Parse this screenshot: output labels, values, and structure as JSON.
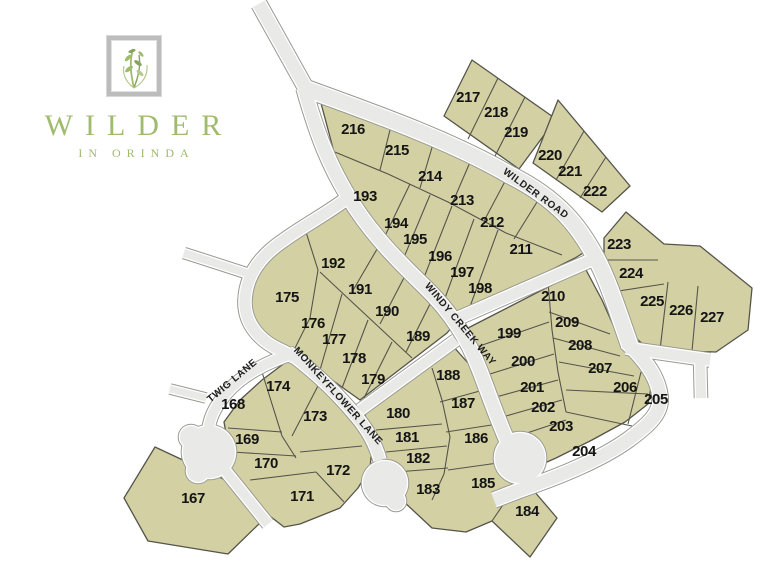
{
  "logo": {
    "title": "WILDER",
    "subtitle": "IN ORINDA"
  },
  "map": {
    "roads": [
      {
        "id": "wilder-road",
        "name": "WILDER ROAD",
        "x": 534,
        "y": 196,
        "angle": 36
      },
      {
        "id": "windy-creek-way",
        "name": "WINDY CREEK WAY",
        "x": 458,
        "y": 326,
        "angle": 50
      },
      {
        "id": "monkeyflower-lane",
        "name": "MONKEYFLOWER LANE",
        "x": 336,
        "y": 398,
        "angle": 48
      },
      {
        "id": "twig-lane",
        "name": "TWIG LANE",
        "x": 234,
        "y": 383,
        "angle": -40
      }
    ],
    "lots": [
      {
        "number": "167",
        "x": 193,
        "y": 498
      },
      {
        "number": "168",
        "x": 233,
        "y": 404
      },
      {
        "number": "169",
        "x": 247,
        "y": 439
      },
      {
        "number": "170",
        "x": 266,
        "y": 463
      },
      {
        "number": "171",
        "x": 302,
        "y": 496
      },
      {
        "number": "172",
        "x": 338,
        "y": 470
      },
      {
        "number": "173",
        "x": 315,
        "y": 416
      },
      {
        "number": "174",
        "x": 278,
        "y": 386
      },
      {
        "number": "175",
        "x": 287,
        "y": 297
      },
      {
        "number": "176",
        "x": 313,
        "y": 323
      },
      {
        "number": "177",
        "x": 334,
        "y": 339
      },
      {
        "number": "178",
        "x": 354,
        "y": 358
      },
      {
        "number": "179",
        "x": 373,
        "y": 379
      },
      {
        "number": "180",
        "x": 398,
        "y": 413
      },
      {
        "number": "181",
        "x": 407,
        "y": 437
      },
      {
        "number": "182",
        "x": 418,
        "y": 458
      },
      {
        "number": "183",
        "x": 428,
        "y": 489
      },
      {
        "number": "184",
        "x": 527,
        "y": 511
      },
      {
        "number": "185",
        "x": 483,
        "y": 483
      },
      {
        "number": "186",
        "x": 476,
        "y": 438
      },
      {
        "number": "187",
        "x": 463,
        "y": 403
      },
      {
        "number": "188",
        "x": 448,
        "y": 375
      },
      {
        "number": "189",
        "x": 418,
        "y": 336
      },
      {
        "number": "190",
        "x": 387,
        "y": 311
      },
      {
        "number": "191",
        "x": 360,
        "y": 289
      },
      {
        "number": "192",
        "x": 333,
        "y": 263
      },
      {
        "number": "193",
        "x": 365,
        "y": 196
      },
      {
        "number": "194",
        "x": 396,
        "y": 223
      },
      {
        "number": "195",
        "x": 415,
        "y": 239
      },
      {
        "number": "196",
        "x": 440,
        "y": 256
      },
      {
        "number": "197",
        "x": 462,
        "y": 272
      },
      {
        "number": "198",
        "x": 480,
        "y": 288
      },
      {
        "number": "199",
        "x": 509,
        "y": 333
      },
      {
        "number": "200",
        "x": 523,
        "y": 361
      },
      {
        "number": "201",
        "x": 532,
        "y": 387
      },
      {
        "number": "202",
        "x": 543,
        "y": 407
      },
      {
        "number": "203",
        "x": 561,
        "y": 426
      },
      {
        "number": "204",
        "x": 584,
        "y": 451
      },
      {
        "number": "205",
        "x": 656,
        "y": 399
      },
      {
        "number": "206",
        "x": 625,
        "y": 387
      },
      {
        "number": "207",
        "x": 600,
        "y": 368
      },
      {
        "number": "208",
        "x": 580,
        "y": 345
      },
      {
        "number": "209",
        "x": 567,
        "y": 322
      },
      {
        "number": "210",
        "x": 553,
        "y": 296
      },
      {
        "number": "211",
        "x": 521,
        "y": 249
      },
      {
        "number": "212",
        "x": 492,
        "y": 222
      },
      {
        "number": "213",
        "x": 462,
        "y": 200
      },
      {
        "number": "214",
        "x": 430,
        "y": 176
      },
      {
        "number": "215",
        "x": 397,
        "y": 150
      },
      {
        "number": "216",
        "x": 353,
        "y": 129
      },
      {
        "number": "217",
        "x": 468,
        "y": 97
      },
      {
        "number": "218",
        "x": 496,
        "y": 112
      },
      {
        "number": "219",
        "x": 516,
        "y": 132
      },
      {
        "number": "220",
        "x": 550,
        "y": 155
      },
      {
        "number": "221",
        "x": 570,
        "y": 171
      },
      {
        "number": "222",
        "x": 595,
        "y": 191
      },
      {
        "number": "223",
        "x": 619,
        "y": 244
      },
      {
        "number": "224",
        "x": 631,
        "y": 273
      },
      {
        "number": "225",
        "x": 652,
        "y": 301
      },
      {
        "number": "226",
        "x": 681,
        "y": 310
      },
      {
        "number": "227",
        "x": 712,
        "y": 317
      }
    ],
    "colors": {
      "parcel": "#d3d1a4",
      "parcel_border": "#55544a",
      "road": "#e9e9e7",
      "road_casing": "#9a9a92",
      "lot_label": "#141414",
      "logo_green": "#9fbb6d",
      "frame_gray": "#bcbcbc"
    }
  }
}
